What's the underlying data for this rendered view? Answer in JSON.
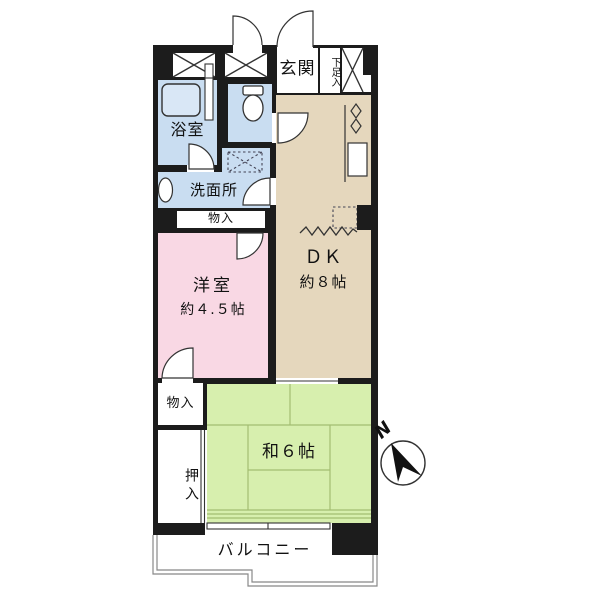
{
  "title": "2DK apartment floor plan",
  "rooms": {
    "genkan": {
      "label": "玄関"
    },
    "shoe_cabinet": {
      "label": "下足入"
    },
    "bathroom": {
      "label": "浴室"
    },
    "washroom": {
      "label": "洗面所"
    },
    "hall_storage": {
      "label": "物入"
    },
    "western_room": {
      "name": "洋室",
      "size": "約４.５帖"
    },
    "dining_kitchen": {
      "name": "ＤＫ",
      "size": "約８帖"
    },
    "japanese_room": {
      "label": "和６帖"
    },
    "bedroom_storage": {
      "label": "物入"
    },
    "oshiire": {
      "label": "押入"
    },
    "balcony": {
      "label": "バルコニー"
    }
  },
  "compass": {
    "north_label": "N"
  },
  "colors": {
    "wall": "#1c1c1c",
    "wet_area_blue": "#c9ddf1",
    "dk_tan": "#e5d7bd",
    "western_pink": "#f9d8e4",
    "tatami_green": "#d7efae",
    "tatami_line": "#a3bd72",
    "outline_gray": "#888888"
  }
}
